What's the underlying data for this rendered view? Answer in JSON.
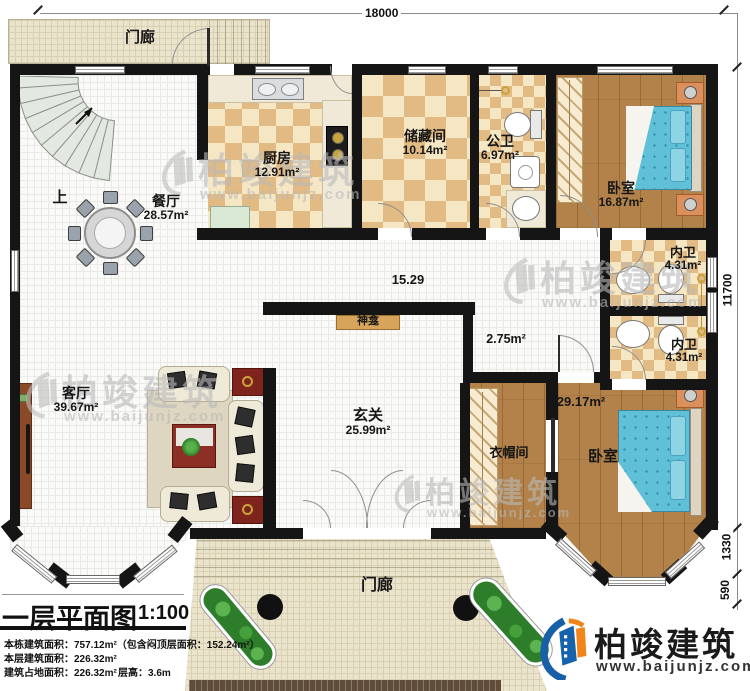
{
  "dimensions": {
    "top": "18000",
    "right_main": "11700",
    "right_bay_depth": "1330",
    "right_bay_edge": "590"
  },
  "rooms": {
    "porch_top": {
      "name": "门廊"
    },
    "stairs": {
      "up_label": "上"
    },
    "dining": {
      "name": "餐厅",
      "area": "28.57m²"
    },
    "kitchen": {
      "name": "厨房",
      "area": "12.91m²"
    },
    "storage": {
      "name": "储藏间",
      "area": "10.14m²"
    },
    "public_bath": {
      "name": "公卫",
      "area": "6.97m²"
    },
    "bedroom_top": {
      "name": "卧室",
      "area": "16.87m²"
    },
    "hallway": {
      "width_label": "15.29"
    },
    "ensuite_top": {
      "name": "内卫",
      "area": "4.31m²"
    },
    "ensuite_bottom": {
      "name": "内卫",
      "area": "4.31m²"
    },
    "corridor": {
      "area": "2.75m²"
    },
    "living": {
      "name": "客厅",
      "area": "39.67m²"
    },
    "foyer": {
      "name": "玄关",
      "area": "25.99m²"
    },
    "shrine": {
      "name": "神龛"
    },
    "cloakroom": {
      "name": "衣帽间"
    },
    "bedroom_bottom": {
      "name": "卧室",
      "area": "29.17m²"
    },
    "porch_bottom": {
      "name": "门廊"
    }
  },
  "title_block": {
    "title": "一层平面图",
    "scale": "1:100",
    "total_area_line": "本栋建筑面积：757.12m²（包含闷顶层面积：152.24m²）",
    "floor_area_line": "本层建筑面积：226.32m²",
    "footprint_line": "建筑占地面积：226.32m²",
    "height_line": "层高：3.6m"
  },
  "branding": {
    "company": "柏竣建筑",
    "website": "www.baijunjz.com"
  },
  "watermark": {
    "company": "柏竣建筑",
    "website": "www.baijunjz.com"
  }
}
